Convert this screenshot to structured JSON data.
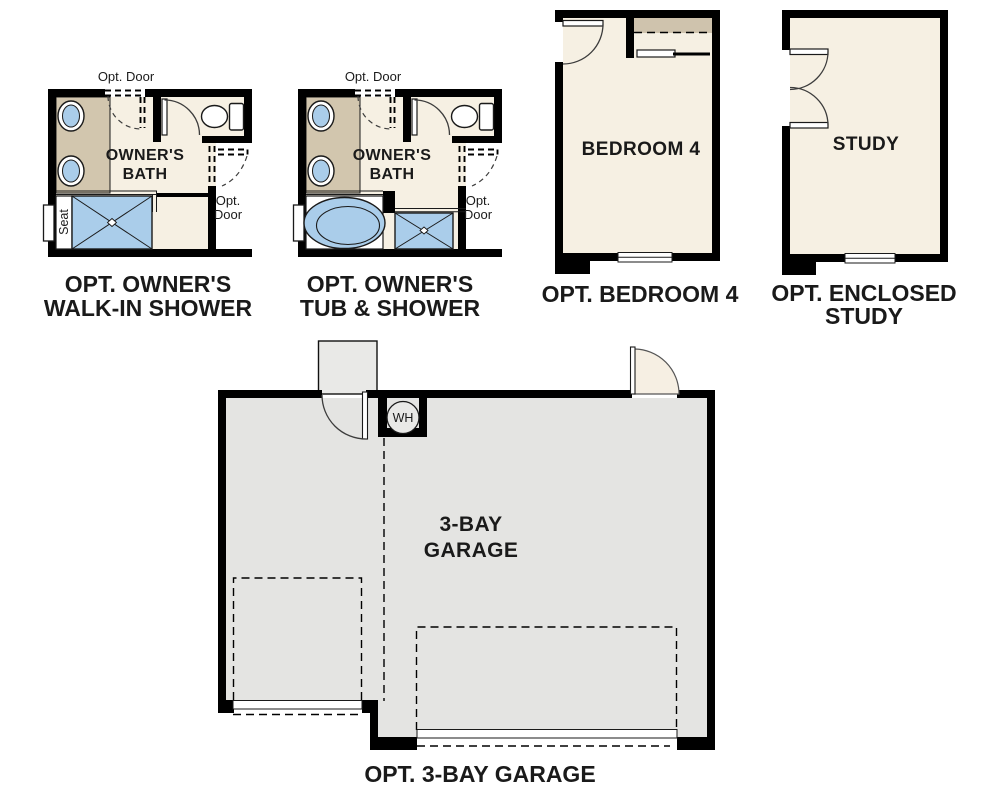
{
  "sheet": {
    "description": "Floor plan options sheet",
    "background": "#ffffff"
  },
  "colors": {
    "wall": "#000000",
    "floor_cream": "#f6f0e3",
    "garage_gray": "#e4e4e2",
    "counter_tan": "#d2c6ae",
    "fixture_blue": "#aacdea",
    "closet_tan": "#cfc3ad",
    "landing_gray": "#e9e9e7",
    "text": "#1a1a1a"
  },
  "plans": {
    "walk_in_shower": {
      "caption_line1": "OPT. OWNER'S",
      "caption_line2": "WALK-IN SHOWER",
      "room_line1": "OWNER'S",
      "room_line2": "BATH",
      "opt_door_top_label": "Opt. Door",
      "opt_door_side_line1": "Opt.",
      "opt_door_side_line2": "Door",
      "seat_label": "Seat"
    },
    "tub_shower": {
      "caption_line1": "OPT. OWNER'S",
      "caption_line2": "TUB & SHOWER",
      "room_line1": "OWNER'S",
      "room_line2": "BATH",
      "opt_door_top_label": "Opt. Door",
      "opt_door_side_line1": "Opt.",
      "opt_door_side_line2": "Door"
    },
    "bedroom4": {
      "caption": "OPT. BEDROOM 4",
      "room_label": "BEDROOM 4"
    },
    "study": {
      "caption_line1": "OPT. ENCLOSED",
      "caption_line2": "STUDY",
      "room_label": "STUDY"
    },
    "garage": {
      "caption": "OPT. 3-BAY GARAGE",
      "room_line1": "3-BAY",
      "room_line2": "GARAGE",
      "water_heater_label": "WH"
    }
  }
}
